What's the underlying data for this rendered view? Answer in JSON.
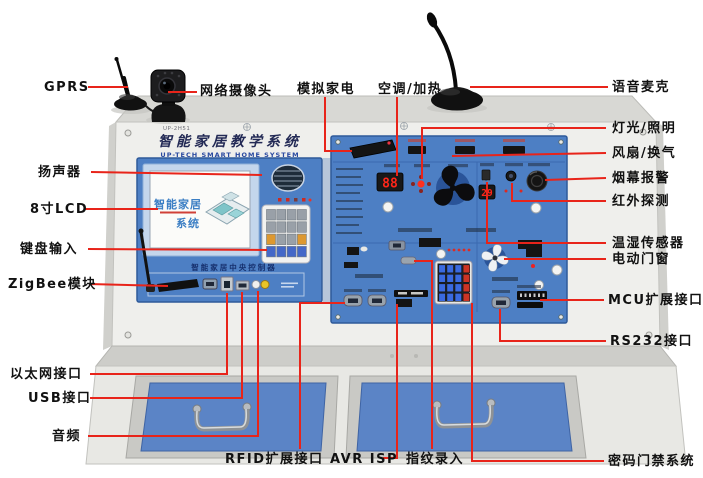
{
  "figure": {
    "model": "UP-2H51",
    "panel_title": "智能家居教学系统",
    "panel_subtitle": "UP-TECH SMART HOME SYSTEM",
    "screen_title_line1": "智能家居",
    "screen_title_line2": "系统",
    "console_caption": "智能家居中央控制器",
    "readout_ac": "88",
    "readout_temp": "29"
  },
  "colors": {
    "leader_line": "#e8241a",
    "panel_blue": "#4d7fc4",
    "drawer_blue": "#5b84c6",
    "cabinet_face": "#efefec",
    "label_text": "#111111",
    "led_red": "#ff2619"
  },
  "callouts": {
    "gprs": "GPRS",
    "network_camera": "网络摄像头",
    "simulated_appliance": "模拟家电",
    "ac_heating": "空调/加热",
    "voice_mic": "语音麦克",
    "speaker": "扬声器",
    "lcd_8inch": "8寸LCD",
    "keypad_input": "键盘输入",
    "zigbee_module": "ZigBee模块",
    "lighting": "灯光/照明",
    "fan_ventilation": "风扇/换气",
    "smoke_alarm": "烟幕报警",
    "infrared_detection": "红外探测",
    "temp_humidity_sensor": "温湿传感器",
    "electric_door_window": "电动门窗",
    "mcu_expansion": "MCU扩展接口",
    "rs232": "RS232接口",
    "ethernet": "以太网接口",
    "usb": "USB接口",
    "audio": "音频",
    "rfid_expansion": "RFID扩展接口",
    "avr_isp": "AVR ISP",
    "fingerprint": "指纹录入",
    "password_access": "密码门禁系统"
  }
}
